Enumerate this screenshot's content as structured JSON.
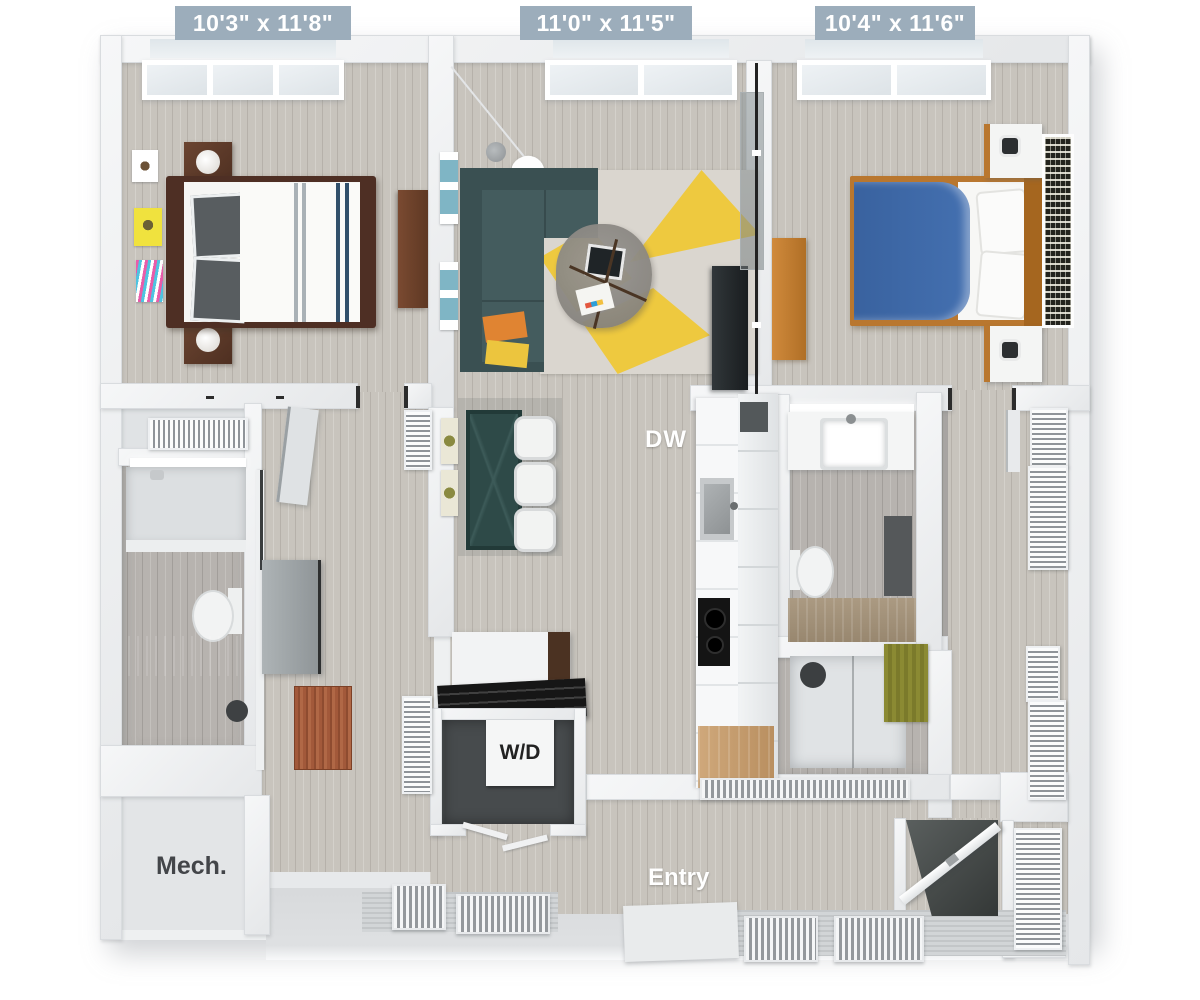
{
  "labels": {
    "bedroom_left_dim": "10'3\" x 11'8\"",
    "living_dim": "11'0\" x 11'5\"",
    "bedroom_right_dim": "10'4\" x 11'6\"",
    "dishwasher": "DW",
    "washer_dryer": "W/D",
    "mech_room": "Mech.",
    "entry": "Entry"
  },
  "colors": {
    "dim_label_bg": "#9cadbb",
    "dim_label_text": "#ffffff",
    "floor_wood": "#c8c4bd",
    "wall": "#eef0f2",
    "sofa_teal": "#41585a",
    "rug_yellow": "#eec93f",
    "bed_blue": "#3e68a8",
    "bed_wood_dark": "#4e2f24",
    "bed_wood_oak": "#b9772f",
    "dining_table_teal": "#2e4a48",
    "vanity_wood": "#a5947d",
    "rug_rust": "#a2593a",
    "rug_olive": "#8b8a33",
    "text_dark": "#434549",
    "text_white": "#ffffff"
  }
}
